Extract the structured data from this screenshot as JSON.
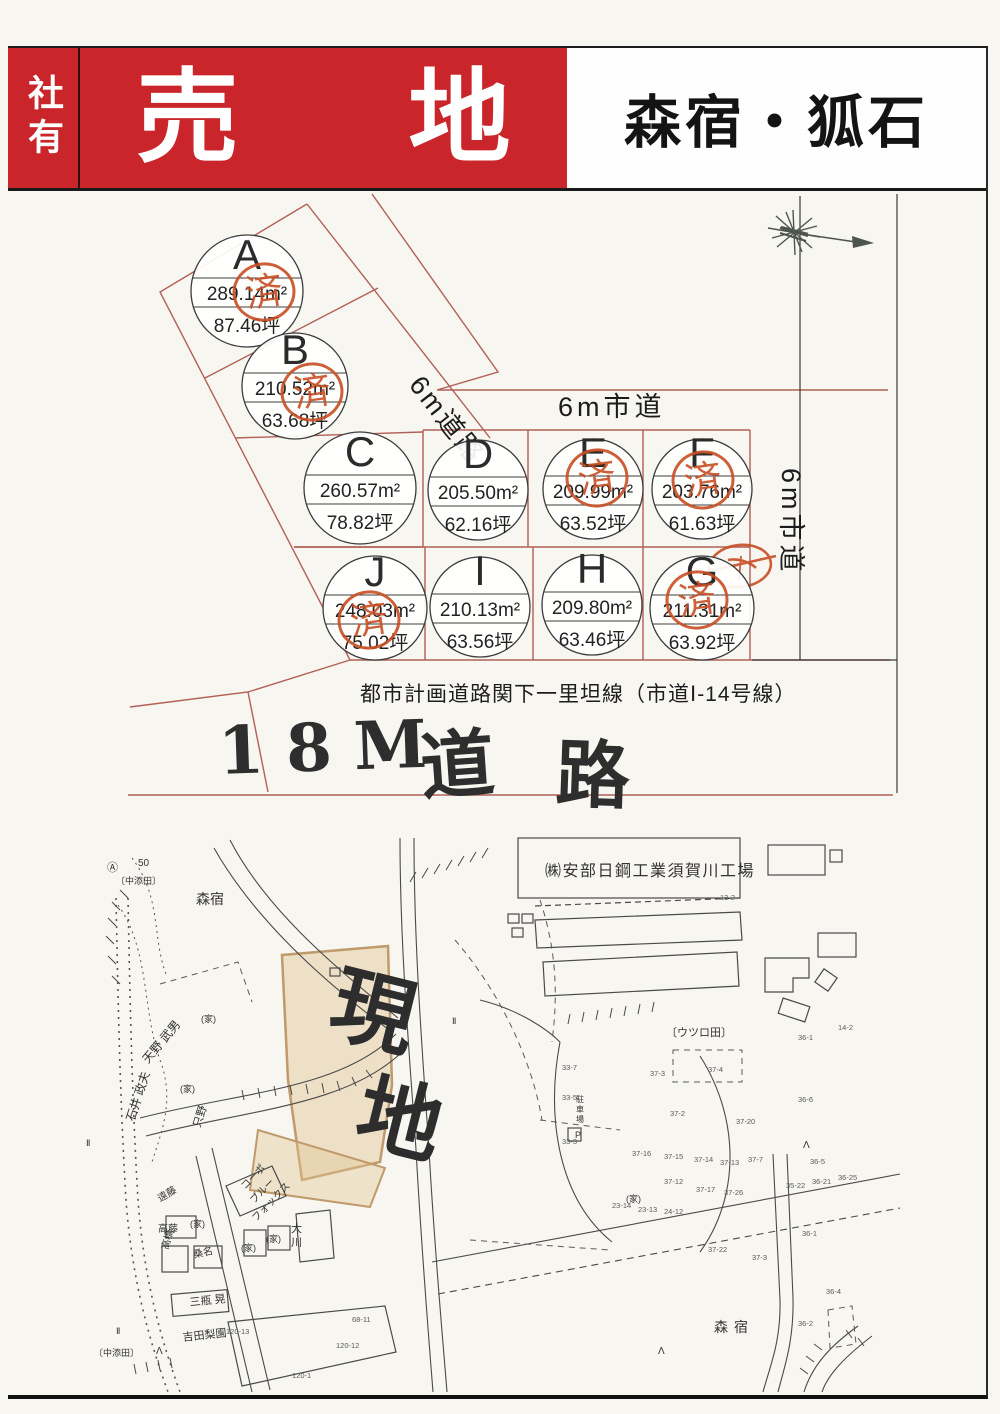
{
  "header": {
    "side_label": "社有",
    "title_chars": [
      "売",
      "地"
    ],
    "area_label": "森宿・狐石",
    "red": "#c9252b"
  },
  "plot_map": {
    "stamp_char": "済",
    "road_label_diagonal": "6m道路",
    "road_label_top": "6m市道",
    "road_label_right": "6m市道",
    "caption": "都市計画道路関下一里坦線（市道Ⅰ-14号線）",
    "handwritten": {
      "part1": "18M",
      "part2": "道",
      "part3": "路"
    },
    "stamp_color": "#c84e24",
    "line_color": "#b26055",
    "plots": [
      {
        "id": "A",
        "m2": "289.14m²",
        "tsubo": "87.46坪",
        "cx": 247,
        "cy": 291,
        "r": 56,
        "sold": true,
        "sdx": 17,
        "sdy": 1
      },
      {
        "id": "B",
        "m2": "210.52m²",
        "tsubo": "63.68坪",
        "cx": 295,
        "cy": 386,
        "r": 53,
        "sold": true,
        "sdx": 17,
        "sdy": 6
      },
      {
        "id": "C",
        "m2": "260.57m²",
        "tsubo": "78.82坪",
        "cx": 360,
        "cy": 488,
        "r": 56,
        "sold": false
      },
      {
        "id": "D",
        "m2": "205.50m²",
        "tsubo": "62.16坪",
        "cx": 478,
        "cy": 490,
        "r": 50,
        "sold": false
      },
      {
        "id": "E",
        "m2": "209.99m²",
        "tsubo": "63.52坪",
        "cx": 593,
        "cy": 489,
        "r": 50,
        "sold": true,
        "sdx": 4,
        "sdy": -11
      },
      {
        "id": "F",
        "m2": "203.76m²",
        "tsubo": "61.63坪",
        "cx": 702,
        "cy": 489,
        "r": 50,
        "sold": true,
        "sdx": 1,
        "sdy": -9
      },
      {
        "id": "J",
        "m2": "248.03m²",
        "tsubo": "75.02坪",
        "cx": 375,
        "cy": 608,
        "r": 52,
        "sold": true,
        "sdx": -6,
        "sdy": 12
      },
      {
        "id": "I",
        "m2": "210.13m²",
        "tsubo": "63.56坪",
        "cx": 480,
        "cy": 607,
        "r": 50,
        "sold": false
      },
      {
        "id": "H",
        "m2": "209.80m²",
        "tsubo": "63.46坪",
        "cx": 592,
        "cy": 605,
        "r": 50,
        "sold": false
      },
      {
        "id": "G",
        "m2": "211.31m²",
        "tsubo": "63.92坪",
        "cx": 702,
        "cy": 608,
        "r": 52,
        "sold": true,
        "sdx": -5,
        "sdy": -8
      }
    ]
  },
  "site_map": {
    "labels": [
      {
        "t": "㈱安部日鋼工業須賀川工場",
        "x": 545,
        "y": 876,
        "s": 16,
        "ls": 1.5
      },
      {
        "t": "森宿",
        "x": 196,
        "y": 904,
        "s": 14
      },
      {
        "t": "〔中添田〕",
        "x": 116,
        "y": 884,
        "s": 9
      },
      {
        "t": "Ⓐ",
        "x": 107,
        "y": 871,
        "s": 11
      },
      {
        "t": "50",
        "x": 138,
        "y": 866,
        "s": 10
      },
      {
        "t": "現",
        "x": 326,
        "y": 1030,
        "s": 84,
        "r": 14,
        "hand": 1
      },
      {
        "t": "地",
        "x": 352,
        "y": 1138,
        "s": 84,
        "r": 14,
        "hand": 1
      },
      {
        "t": "〔ウツロ田〕",
        "x": 666,
        "y": 1036,
        "s": 11
      },
      {
        "t": "天野 武男",
        "x": 148,
        "y": 1064,
        "s": 12,
        "r": -50
      },
      {
        "t": "石井 政夫",
        "x": 134,
        "y": 1122,
        "s": 12,
        "r": -72
      },
      {
        "t": "只野",
        "x": 200,
        "y": 1128,
        "s": 11,
        "r": -72
      },
      {
        "t": "遠藤",
        "x": 160,
        "y": 1202,
        "s": 10,
        "r": -30
      },
      {
        "t": "高藤",
        "x": 158,
        "y": 1232,
        "s": 10
      },
      {
        "t": "(家)",
        "x": 190,
        "y": 1227,
        "s": 9
      },
      {
        "t": "高橋",
        "x": 168,
        "y": 1250,
        "s": 10,
        "r": -75
      },
      {
        "t": "桑名",
        "x": 194,
        "y": 1258,
        "s": 10,
        "r": -12
      },
      {
        "t": "三瓶 晃",
        "x": 190,
        "y": 1306,
        "s": 11,
        "r": -6
      },
      {
        "t": "吉田梨園",
        "x": 183,
        "y": 1341,
        "s": 11,
        "r": -6
      },
      {
        "t": "コーポ",
        "x": 245,
        "y": 1190,
        "s": 10,
        "r": -46
      },
      {
        "t": "ブルー",
        "x": 254,
        "y": 1204,
        "s": 10,
        "r": -46
      },
      {
        "t": "フォックス",
        "x": 256,
        "y": 1222,
        "s": 10,
        "r": -46
      },
      {
        "t": "大",
        "x": 291,
        "y": 1232,
        "s": 11
      },
      {
        "t": "川",
        "x": 291,
        "y": 1246,
        "s": 11
      },
      {
        "t": "(家)",
        "x": 201,
        "y": 1022,
        "s": 9
      },
      {
        "t": "(家)",
        "x": 180,
        "y": 1092,
        "s": 9
      },
      {
        "t": "(家)",
        "x": 241,
        "y": 1251,
        "s": 9
      },
      {
        "t": "(家)",
        "x": 266,
        "y": 1242,
        "s": 9
      },
      {
        "t": "(家)",
        "x": 626,
        "y": 1202,
        "s": 9
      },
      {
        "t": "駐",
        "x": 576,
        "y": 1102,
        "s": 8
      },
      {
        "t": "車",
        "x": 576,
        "y": 1112,
        "s": 8
      },
      {
        "t": "場",
        "x": 576,
        "y": 1122,
        "s": 8
      },
      {
        "t": "P",
        "x": 575,
        "y": 1138,
        "s": 9
      },
      {
        "t": "森宿",
        "x": 714,
        "y": 1332,
        "s": 14,
        "ls": 6
      },
      {
        "t": "〔中添田〕",
        "x": 94,
        "y": 1356,
        "s": 9
      },
      {
        "t": "Ⅱ",
        "x": 86,
        "y": 1146,
        "s": 9
      },
      {
        "t": "Ⅱ",
        "x": 116,
        "y": 1334,
        "s": 9
      },
      {
        "t": "Ⅱ",
        "x": 452,
        "y": 1024,
        "s": 9
      },
      {
        "t": "Λ",
        "x": 803,
        "y": 1148,
        "s": 10
      },
      {
        "t": "Λ",
        "x": 658,
        "y": 1354,
        "s": 10
      },
      {
        "t": "Λ",
        "x": 156,
        "y": 1354,
        "s": 10
      }
    ],
    "lots": [
      {
        "t": "13-2",
        "x": 720,
        "y": 900
      },
      {
        "t": "14-2",
        "x": 838,
        "y": 1030
      },
      {
        "t": "36-1",
        "x": 798,
        "y": 1040
      },
      {
        "t": "33-7",
        "x": 562,
        "y": 1070
      },
      {
        "t": "33-5",
        "x": 562,
        "y": 1100
      },
      {
        "t": "33-3",
        "x": 562,
        "y": 1144
      },
      {
        "t": "37-3",
        "x": 650,
        "y": 1076
      },
      {
        "t": "37-4",
        "x": 708,
        "y": 1072
      },
      {
        "t": "37-2",
        "x": 670,
        "y": 1116
      },
      {
        "t": "37-20",
        "x": 736,
        "y": 1124
      },
      {
        "t": "36-6",
        "x": 798,
        "y": 1102
      },
      {
        "t": "36-5",
        "x": 810,
        "y": 1164
      },
      {
        "t": "37-16",
        "x": 632,
        "y": 1156
      },
      {
        "t": "37-15",
        "x": 664,
        "y": 1159
      },
      {
        "t": "37-14",
        "x": 694,
        "y": 1162
      },
      {
        "t": "37-13",
        "x": 720,
        "y": 1165
      },
      {
        "t": "37-7",
        "x": 748,
        "y": 1162
      },
      {
        "t": "37-12",
        "x": 664,
        "y": 1184
      },
      {
        "t": "37-17",
        "x": 696,
        "y": 1192
      },
      {
        "t": "37-26",
        "x": 724,
        "y": 1195
      },
      {
        "t": "35-22",
        "x": 786,
        "y": 1188
      },
      {
        "t": "36-21",
        "x": 812,
        "y": 1184
      },
      {
        "t": "36-25",
        "x": 838,
        "y": 1180
      },
      {
        "t": "23-14",
        "x": 612,
        "y": 1208
      },
      {
        "t": "23-13",
        "x": 638,
        "y": 1212
      },
      {
        "t": "24-12",
        "x": 664,
        "y": 1214
      },
      {
        "t": "37-22",
        "x": 708,
        "y": 1252
      },
      {
        "t": "37-3",
        "x": 752,
        "y": 1260
      },
      {
        "t": "36-1",
        "x": 802,
        "y": 1236
      },
      {
        "t": "36-2",
        "x": 798,
        "y": 1326
      },
      {
        "t": "36-4",
        "x": 826,
        "y": 1294
      },
      {
        "t": "120-13",
        "x": 226,
        "y": 1334
      },
      {
        "t": "68-11",
        "x": 352,
        "y": 1322
      },
      {
        "t": "120-12",
        "x": 336,
        "y": 1348
      },
      {
        "t": "120-1",
        "x": 292,
        "y": 1378
      }
    ]
  }
}
